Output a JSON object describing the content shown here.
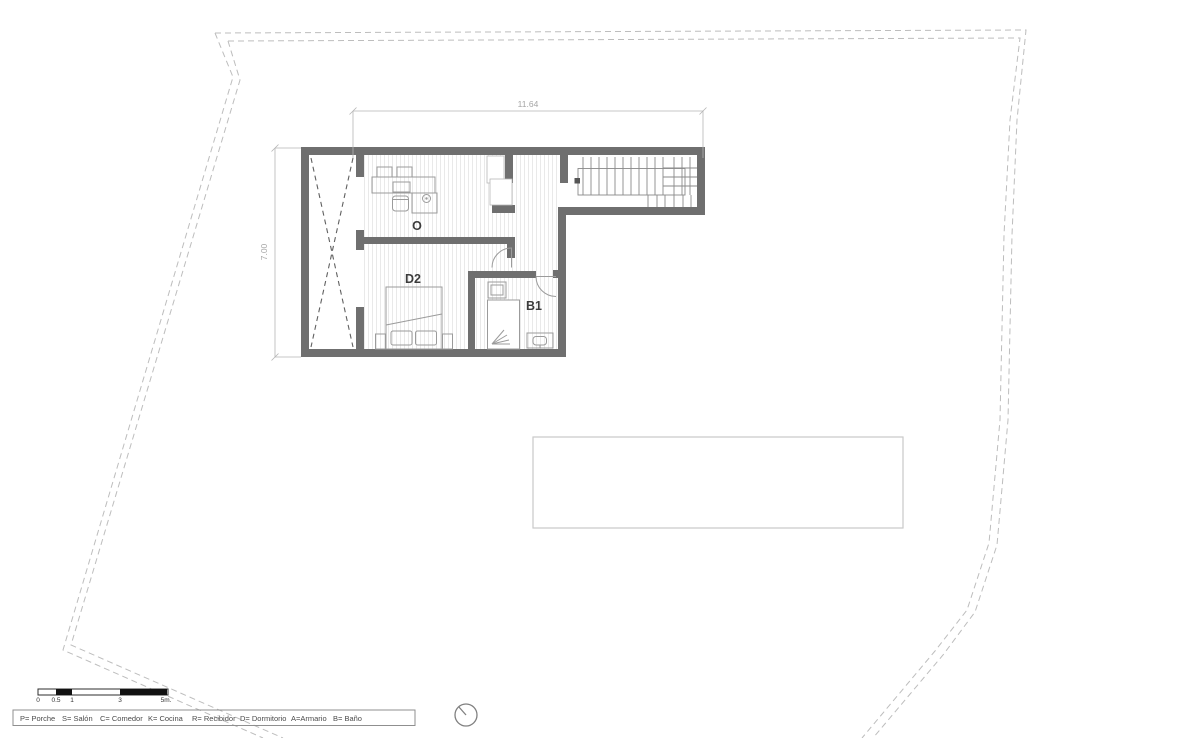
{
  "dimensions": {
    "top_width": "11.64",
    "left_height": "7.00"
  },
  "rooms": {
    "office": {
      "label": "O"
    },
    "bedroom": {
      "label": "D2"
    },
    "bathroom": {
      "label": "B1"
    }
  },
  "scale_bar": {
    "ticks": [
      "0",
      "0.5",
      "1",
      "3",
      "5m."
    ]
  },
  "legend": {
    "items": [
      "P= Porche",
      "S= Salón",
      "C= Comedor",
      "K= Cocina",
      "R= Recibidor",
      "D= Dormitorio",
      "A=Armario",
      "B= Baño"
    ]
  },
  "colors": {
    "wall": "#6f6f6f",
    "furniture": "#9b9b9b",
    "parcel_boundary": "#bdbdbd",
    "dimension": "#a5a5a5",
    "floor_hatch": "#e9e9e9",
    "room_label": "#3c3c3c"
  }
}
